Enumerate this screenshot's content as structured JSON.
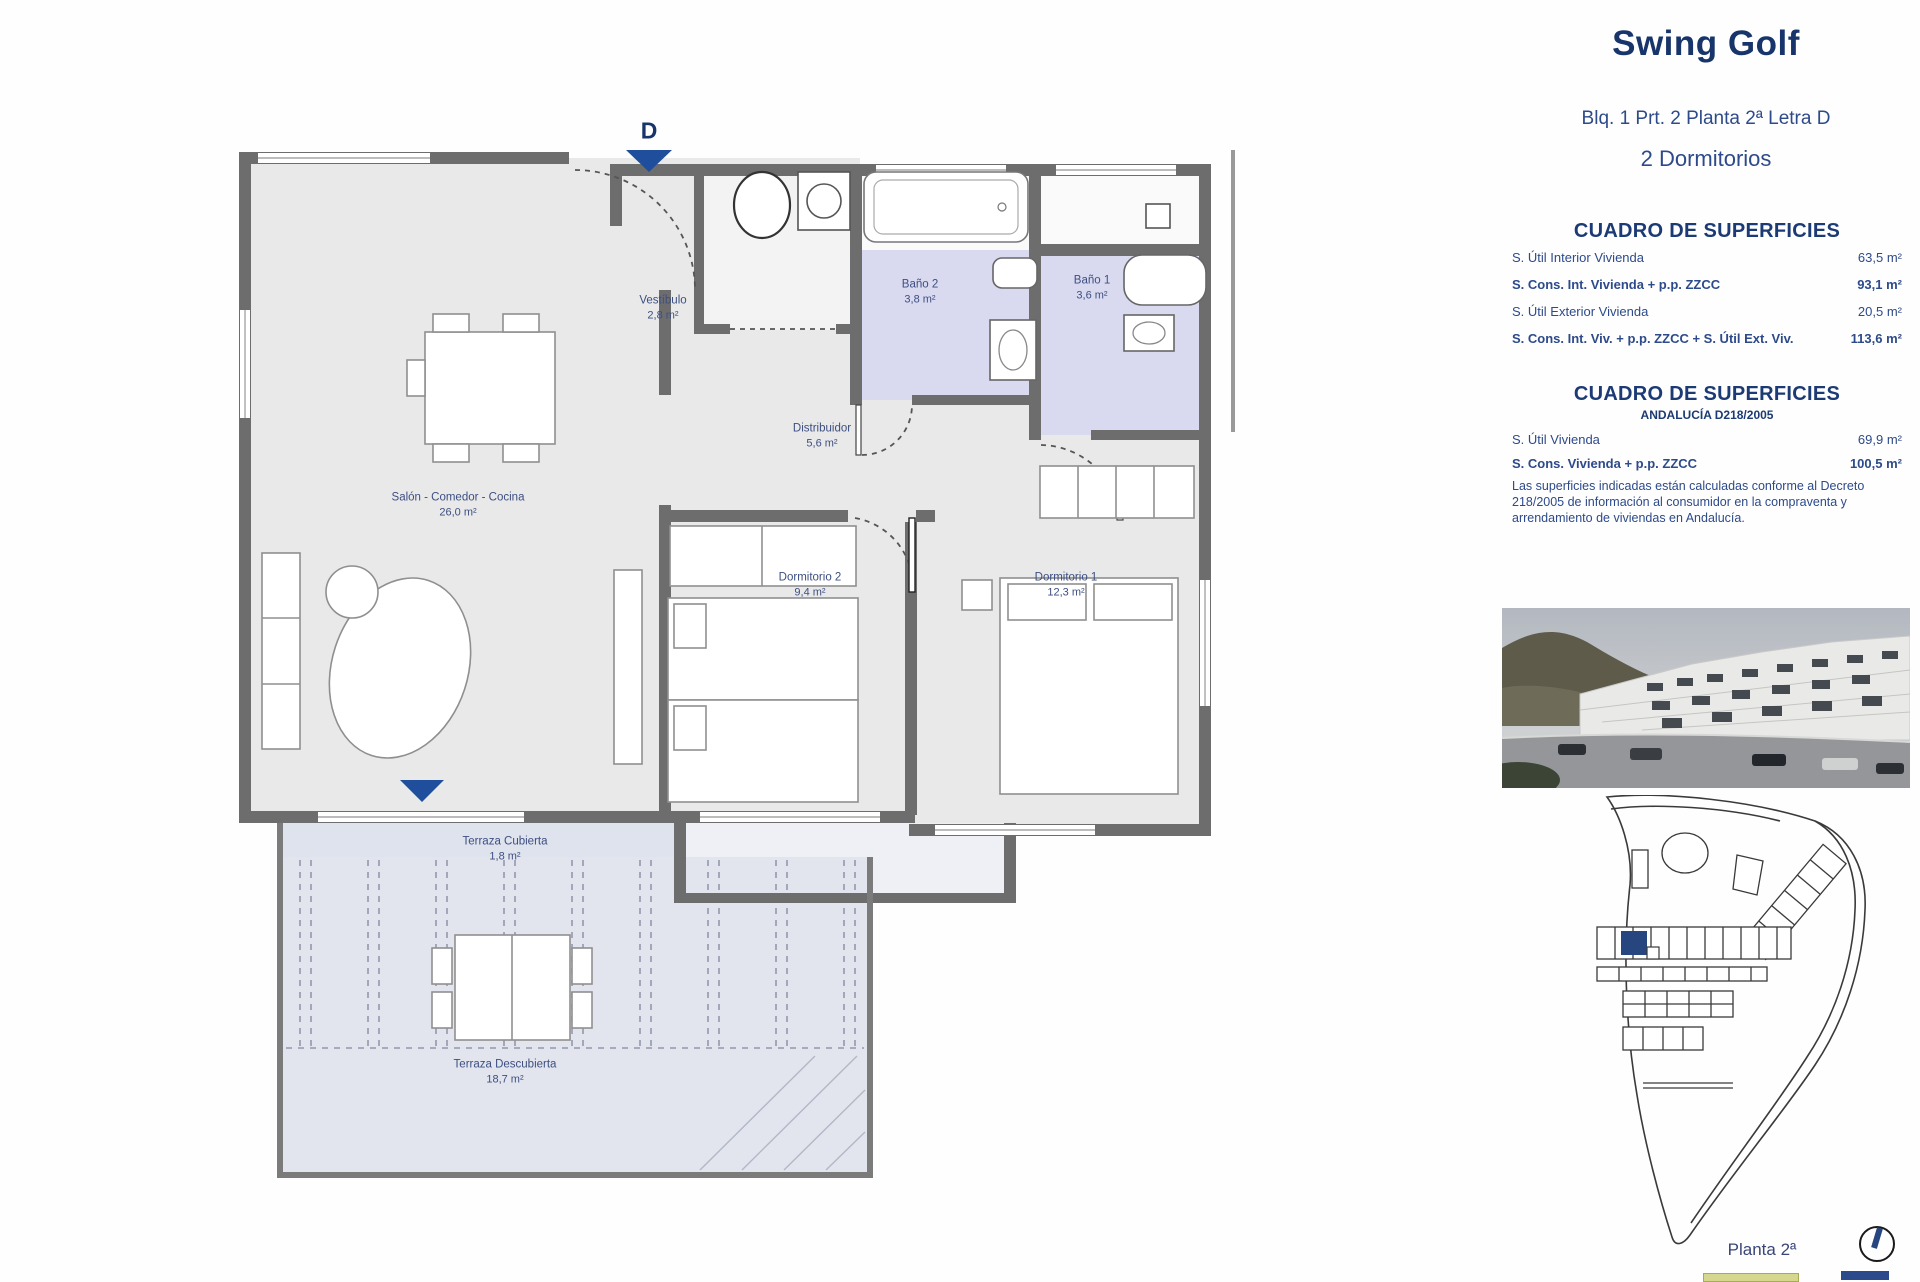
{
  "header": {
    "title": "Swing Golf",
    "subtitle": "Blq. 1 Prt. 2 Planta 2ª Letra D",
    "bedrooms": "2 Dormitorios"
  },
  "surface_table_1": {
    "heading": "CUADRO DE SUPERFICIES",
    "rows": [
      {
        "label": "S. Útil Interior Vivienda",
        "value": "63,5 m²"
      },
      {
        "label": "S. Cons. Int. Vivienda + p.p. ZZCC",
        "value": "93,1 m²"
      },
      {
        "label": "S. Útil Exterior Vivienda",
        "value": "20,5 m²"
      },
      {
        "label": "S. Cons. Int. Viv. + p.p. ZZCC + S. Útil Ext. Viv.",
        "value": "113,6 m²"
      }
    ]
  },
  "surface_table_2": {
    "heading": "CUADRO DE SUPERFICIES",
    "subheading": "ANDALUCÍA D218/2005",
    "rows": [
      {
        "label": "S. Útil Vivienda",
        "value": "69,9 m²"
      },
      {
        "label": "S. Cons. Vivienda + p.p. ZZCC",
        "value": "100,5 m²"
      }
    ],
    "note": "Las superficies indicadas están calculadas conforme al Decreto 218/2005 de información al consumidor en la compraventa y arrendamiento de viviendas en Andalucía."
  },
  "floorplan": {
    "entrance_letter": "D",
    "rooms": [
      {
        "name": "Vestíbulo",
        "area": "2,8 m²"
      },
      {
        "name": "Baño 2",
        "area": "3,8 m²"
      },
      {
        "name": "Baño 1",
        "area": "3,6 m²"
      },
      {
        "name": "Distribuidor",
        "area": "5,6 m²"
      },
      {
        "name": "Salón - Comedor - Cocina",
        "area": "26,0 m²"
      },
      {
        "name": "Dormitorio 2",
        "area": "9,4 m²"
      },
      {
        "name": "Dormitorio 1",
        "area": "12,3 m²"
      },
      {
        "name": "Terraza Cubierta",
        "area": "1,8 m²"
      },
      {
        "name": "Terraza Descubierta",
        "area": "18,7 m²"
      }
    ]
  },
  "siteplan": {
    "floor_label": "Planta 2ª"
  },
  "colors": {
    "title_navy": "#17356b",
    "text_navy": "#2d4a8a",
    "marker_blue": "#1f4e9c",
    "wall_gray": "#6d6d6d",
    "bathroom_lavender": "#d9d9ef",
    "terrace_blue_gray": "#e2e5ee",
    "site_highlight": "#27457f"
  }
}
